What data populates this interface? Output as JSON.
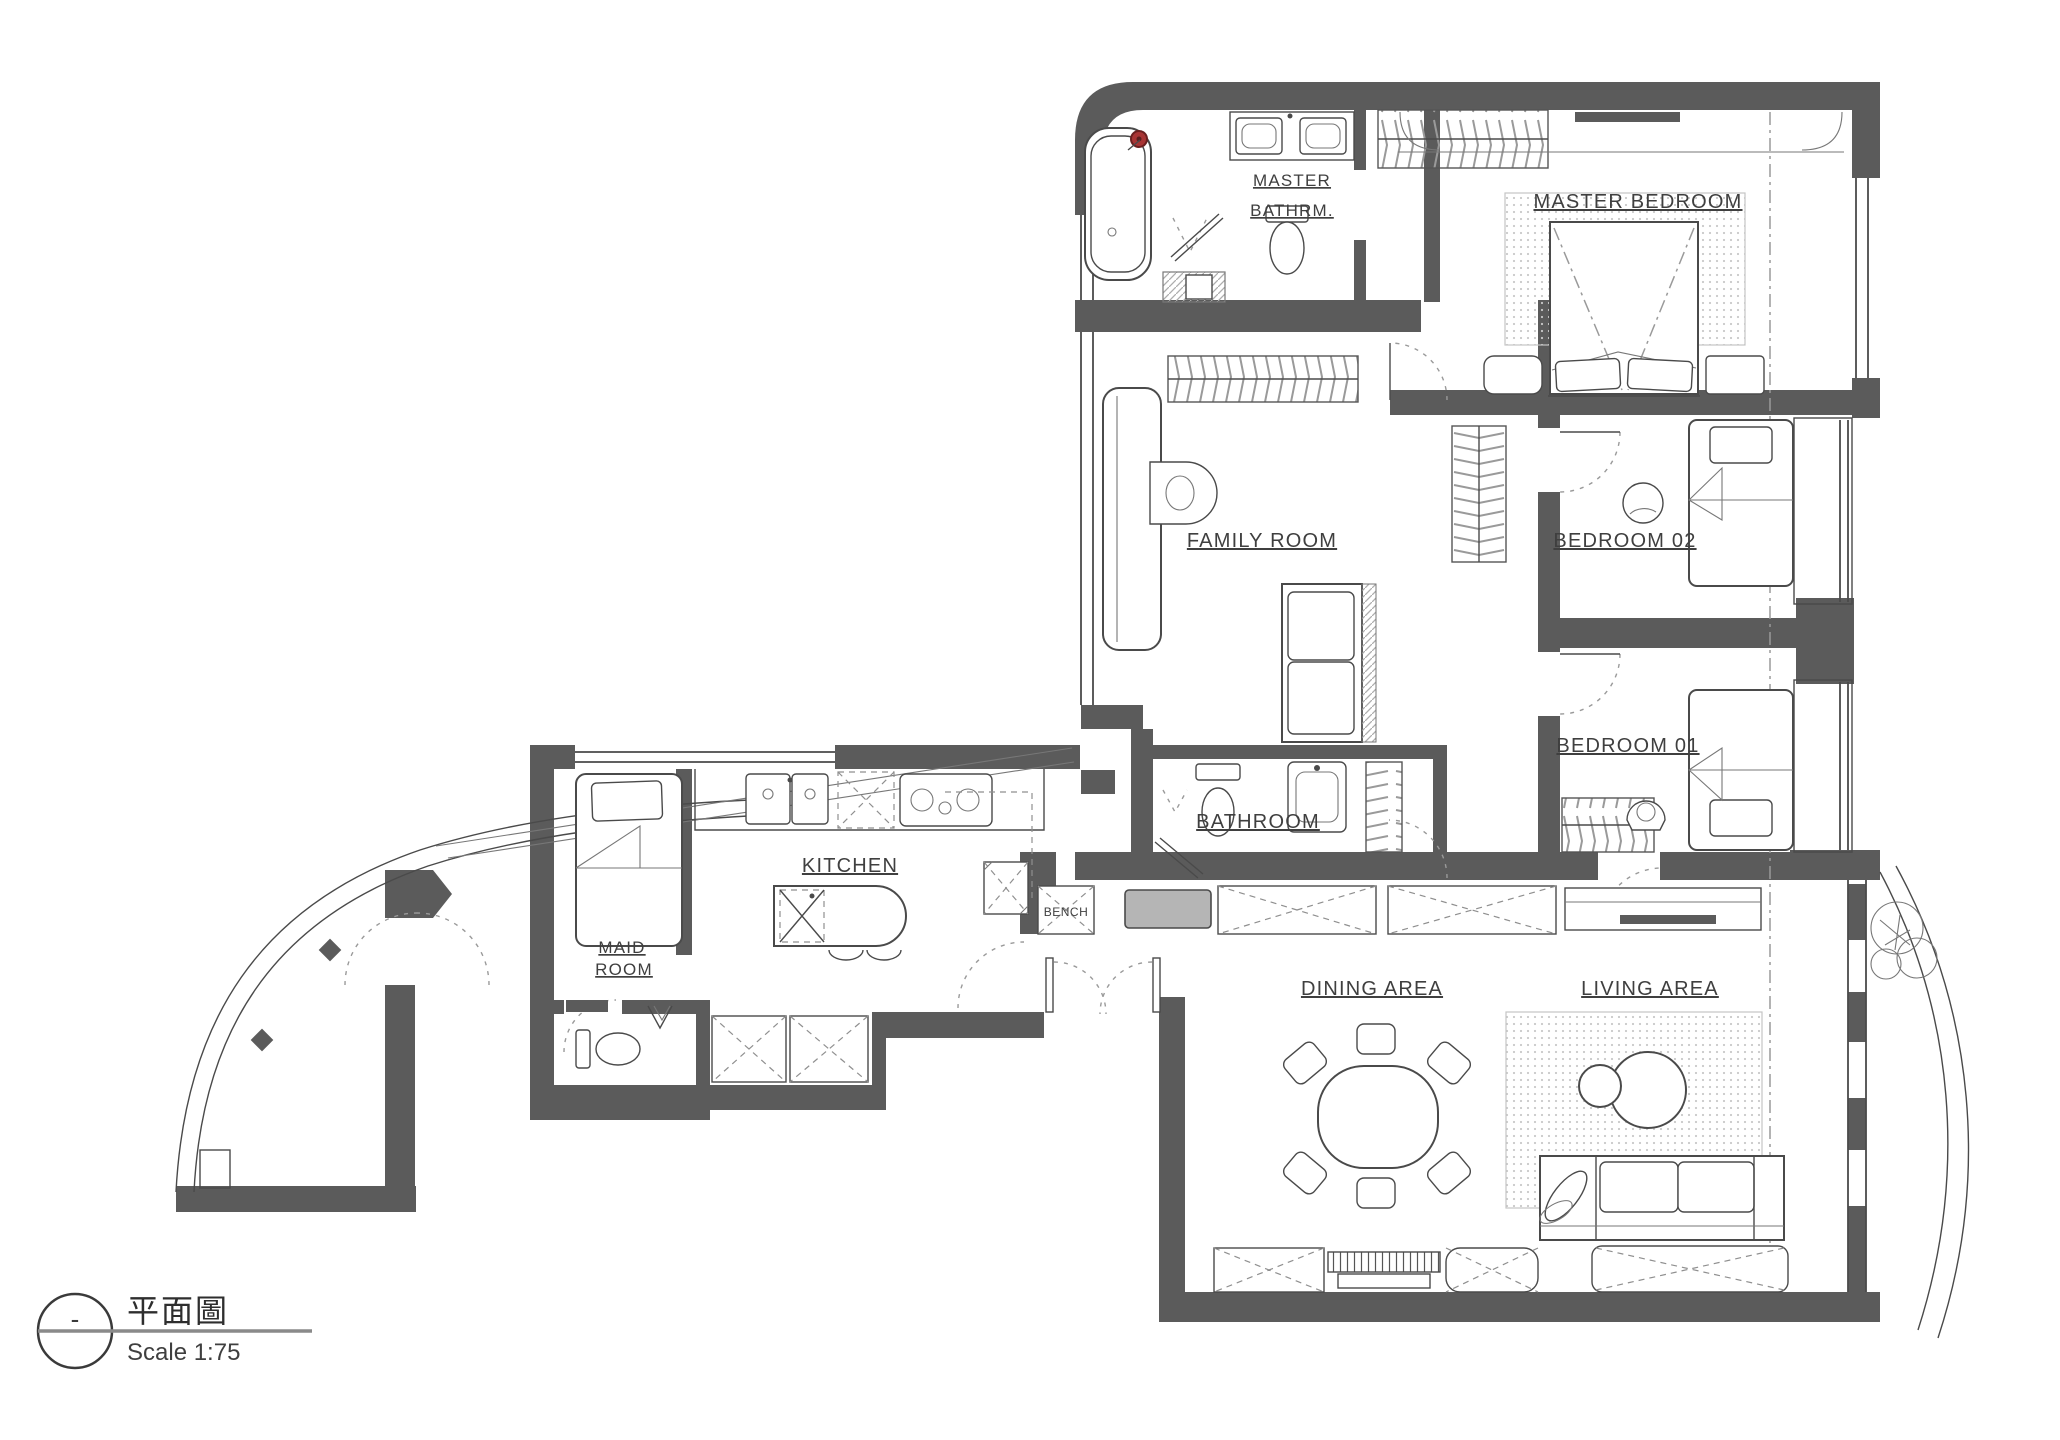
{
  "drawing": {
    "type": "floor-plan",
    "title": "平面圖",
    "scale_label": "Scale 1:75",
    "marker": "-"
  },
  "rooms": [
    {
      "id": "master-bathroom",
      "lines": [
        "MASTER",
        "BATHRM."
      ]
    },
    {
      "id": "master-bedroom",
      "lines": [
        "MASTER BEDROOM"
      ]
    },
    {
      "id": "family-room",
      "lines": [
        "FAMILY ROOM"
      ]
    },
    {
      "id": "bedroom-02",
      "lines": [
        "BEDROOM 02"
      ]
    },
    {
      "id": "bedroom-01",
      "lines": [
        "BEDROOM 01"
      ]
    },
    {
      "id": "bathroom",
      "lines": [
        "BATHROOM"
      ]
    },
    {
      "id": "kitchen",
      "lines": [
        "KITCHEN"
      ]
    },
    {
      "id": "maid-room",
      "lines": [
        "MAID",
        "ROOM"
      ]
    },
    {
      "id": "dining-area",
      "lines": [
        "DINING AREA"
      ]
    },
    {
      "id": "living-area",
      "lines": [
        "LIVING AREA"
      ]
    }
  ],
  "annotations": [
    {
      "id": "bench",
      "label": "BENCH"
    }
  ],
  "colors": {
    "wall": "#5b5b5b",
    "line": "#4a4a4a",
    "label": "#3f3f3f",
    "accent_red": "#a83434",
    "bench_cushion": "#b5b5b5",
    "background": "#ffffff"
  }
}
